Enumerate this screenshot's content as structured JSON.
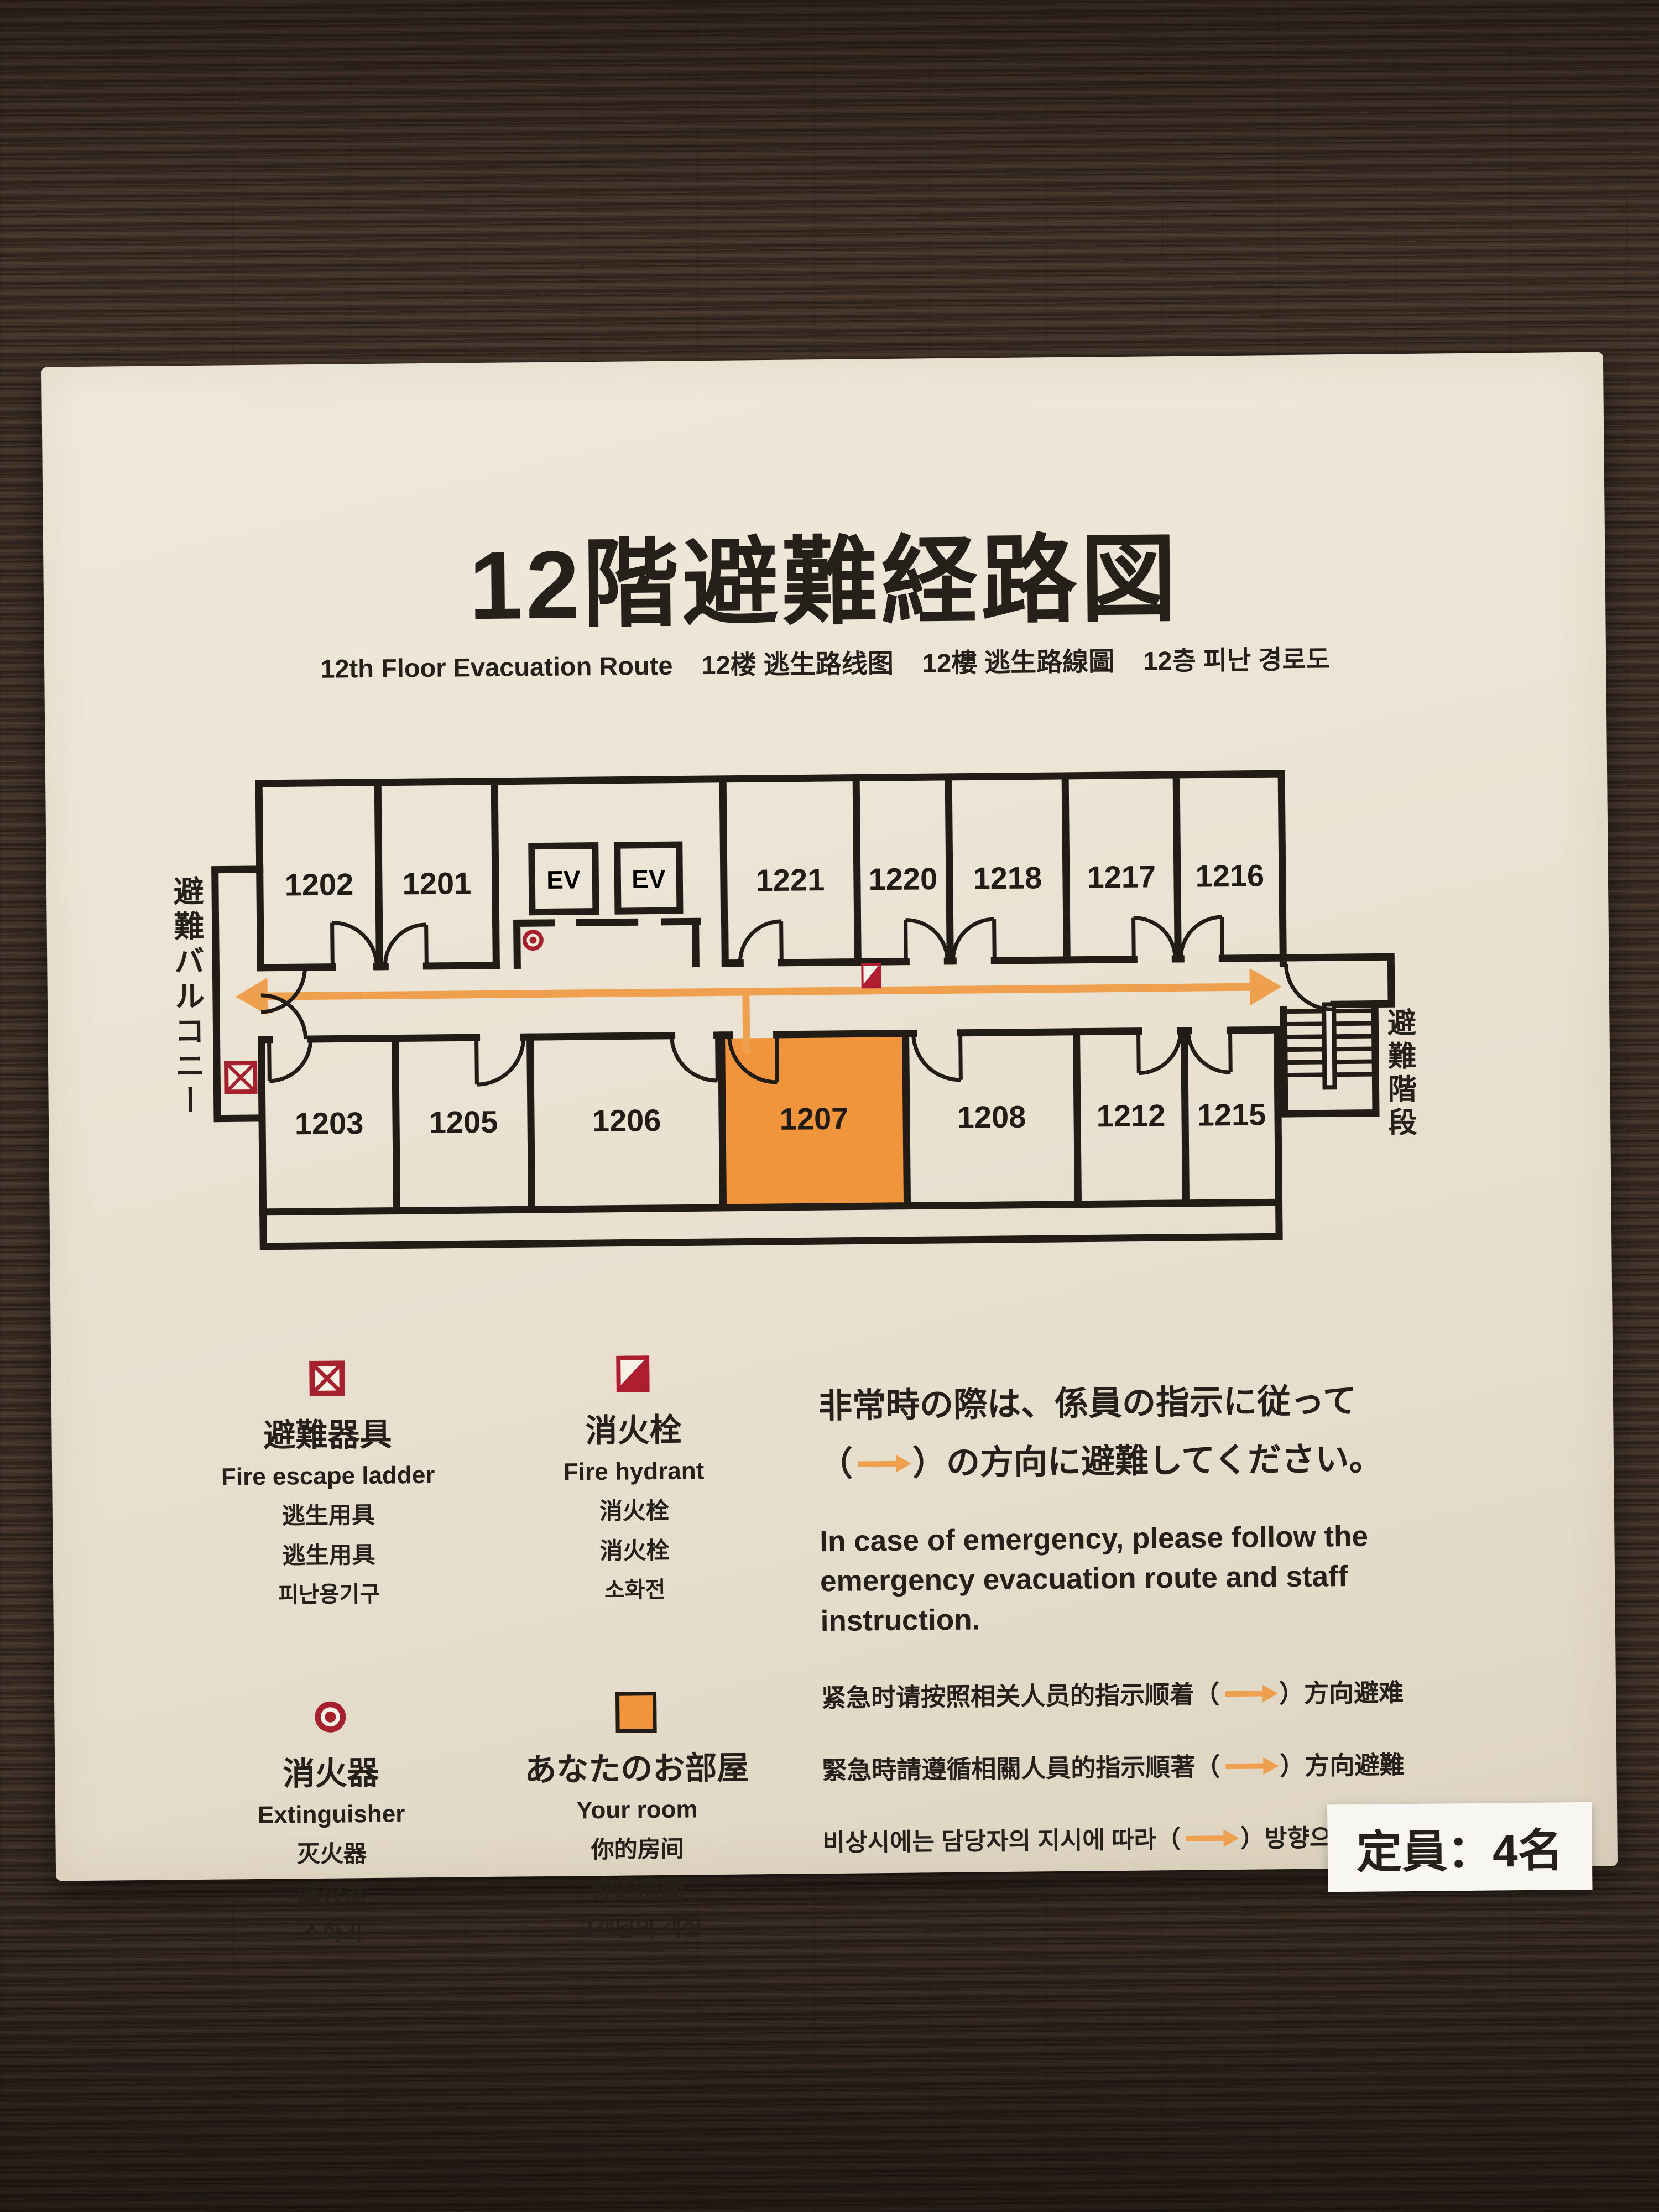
{
  "sign": {
    "title": "12階避難経路図",
    "subtitle": {
      "en": "12th Floor Evacuation Route",
      "zh_s": "12楼 逃生路线图",
      "zh_t": "12樓 逃生路線圖",
      "ko": "12층 피난 경로도"
    },
    "floor_plan": {
      "balcony_label": "避難バルコニー",
      "stairs_label": "避難階段",
      "elevator_labels": [
        "EV",
        "EV"
      ],
      "rooms_top": [
        {
          "label": "1202"
        },
        {
          "label": "1201"
        },
        {
          "label": "1221"
        },
        {
          "label": "1220"
        },
        {
          "label": "1218"
        },
        {
          "label": "1217"
        },
        {
          "label": "1216"
        }
      ],
      "rooms_bottom": [
        {
          "label": "1203"
        },
        {
          "label": "1205"
        },
        {
          "label": "1206"
        },
        {
          "label": "1207",
          "highlight": true
        },
        {
          "label": "1208"
        },
        {
          "label": "1212"
        },
        {
          "label": "1215"
        }
      ],
      "highlighted_room": "1207"
    },
    "legend": [
      {
        "icon": "fire-escape-ladder-icon",
        "jp": "避難器具",
        "en": "Fire escape ladder",
        "zh_s": "逃生用具",
        "zh_t": "逃生用具",
        "ko": "피난용기구"
      },
      {
        "icon": "fire-hydrant-icon",
        "jp": "消火栓",
        "en": "Fire hydrant",
        "zh_s": "消火栓",
        "zh_t": "消火栓",
        "ko": "소화전"
      },
      {
        "icon": "extinguisher-icon",
        "jp": "消火器",
        "en": "Extinguisher",
        "zh_s": "灭火器",
        "zh_t": "滅火器",
        "ko": "소화기"
      },
      {
        "icon": "your-room-icon",
        "jp": "あなたのお部屋",
        "en": "Your room",
        "zh_s": "你的房间",
        "zh_t": "你的房間",
        "ko": "고객님의 객실"
      }
    ],
    "notice": {
      "jp_1": "非常時の際は、係員の指示に従って",
      "jp_2_pre": "（",
      "jp_2_post": "）の方向に避難してください。",
      "en": "In case of emergency, please follow the emergency evacuation route and staff instruction.",
      "zh_s_pre": "紧急时请按照相关人员的指示顺着（",
      "zh_s_post": "）方向避难",
      "zh_t_pre": "緊急時請遵循相關人員的指示順著（",
      "zh_t_post": "）方向避難",
      "ko_pre": "비상시에는 담당자의 지시에 따라（",
      "ko_post": "）방향으로"
    },
    "capacity": "定員：4名",
    "colors": {
      "highlight_orange": "#F0953C",
      "route_orange": "#EFA04E",
      "icon_red": "#A6202E",
      "sign_bg": "#EAE2D2",
      "ink": "#26201B"
    }
  }
}
